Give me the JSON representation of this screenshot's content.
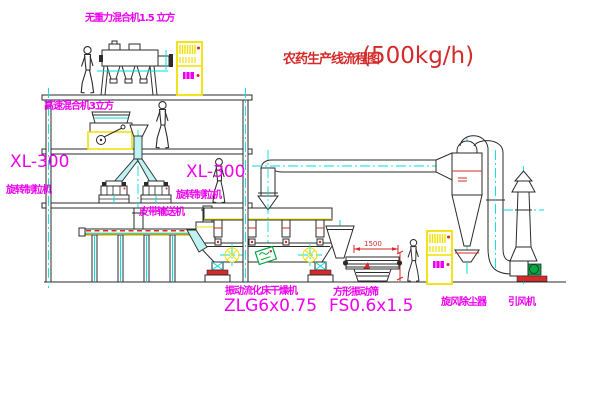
{
  "title": {
    "text": "农药生产线流程图",
    "capacity": "(500kg/h)"
  },
  "labels": {
    "gravity_mixer": "无重力混合机1.5 立方",
    "high_speed_mixer": "高速混合机3立方",
    "granulator_left_model": "XL-300",
    "granulator_left_name": "旋转制粒机",
    "granulator_right_model": "XL-300",
    "granulator_right_name": "旋转制粒机",
    "belt_conveyor": "皮带输送机",
    "dryer_name": "振动流化床干燥机",
    "dryer_model": "ZLG6x0.75",
    "sieve_name": "方形振动筛",
    "sieve_model": "FS0.6x1.5",
    "cyclone": "旋风除尘器",
    "fan": "引风机"
  },
  "dimensions": {
    "sieve_length": "1500"
  },
  "colors": {
    "magenta": "#ee00ee",
    "red": "#d42a2a",
    "yellow": "#f0e000",
    "cyan": "#00dede",
    "green": "#00a843",
    "line": "#2b2b2b",
    "bg": "#ffffff"
  }
}
